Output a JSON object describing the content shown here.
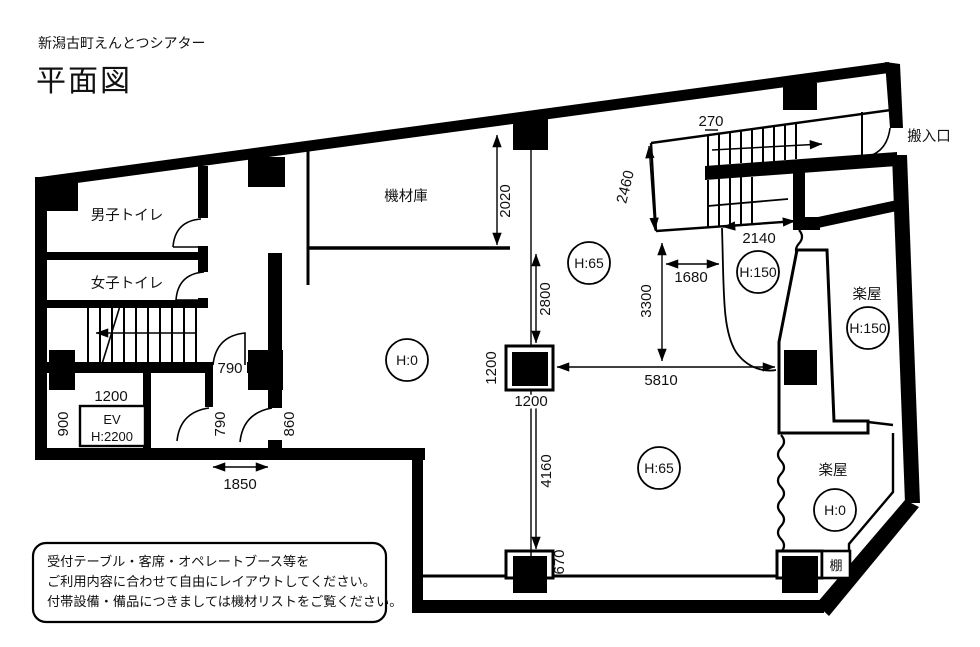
{
  "title": {
    "building": "新潟古町えんとつシアター",
    "drawing": "平面図"
  },
  "rooms": {
    "mens_toilet": "男子トイレ",
    "womens_toilet": "女子トイレ",
    "equipment_storage": "機材庫",
    "loading_entrance": "搬入口",
    "dressing_room_upper": "楽屋",
    "dressing_room_lower": "楽屋",
    "shelf": "棚",
    "elevator_label": "EV",
    "elevator_height": "H:2200"
  },
  "height_marks": {
    "hall_center": "H:0",
    "mid_front": "H:65",
    "stage_left": "H:150",
    "hall_rear": "H:65",
    "dressing_upper": "H:150",
    "dressing_lower": "H:0"
  },
  "dimensions": {
    "stair_tread": "270",
    "stair_width": "2460",
    "stair_length": "2140",
    "front_gap": "1680",
    "front_depth": "3300",
    "hall_span": "5810",
    "storage_depth": "2020",
    "column_front": "2800",
    "column_width": "1200",
    "column_depth": "1200",
    "rear_depth": "4160",
    "rear_offset": "670",
    "door_hall": "790",
    "door_ev_hall": "790",
    "door_main": "860",
    "ev_width": "1200",
    "ev_depth": "900",
    "corridor_width": "1850"
  },
  "note": {
    "line1": "受付テーブル・客席・オペレートブース等を",
    "line2": "ご利用内容に合わせて自由にレイアウトしてください。",
    "line3": "付帯設備・備品につきましては機材リストをご覧ください。"
  },
  "colors": {
    "ink": "#000000",
    "background": "#ffffff"
  }
}
